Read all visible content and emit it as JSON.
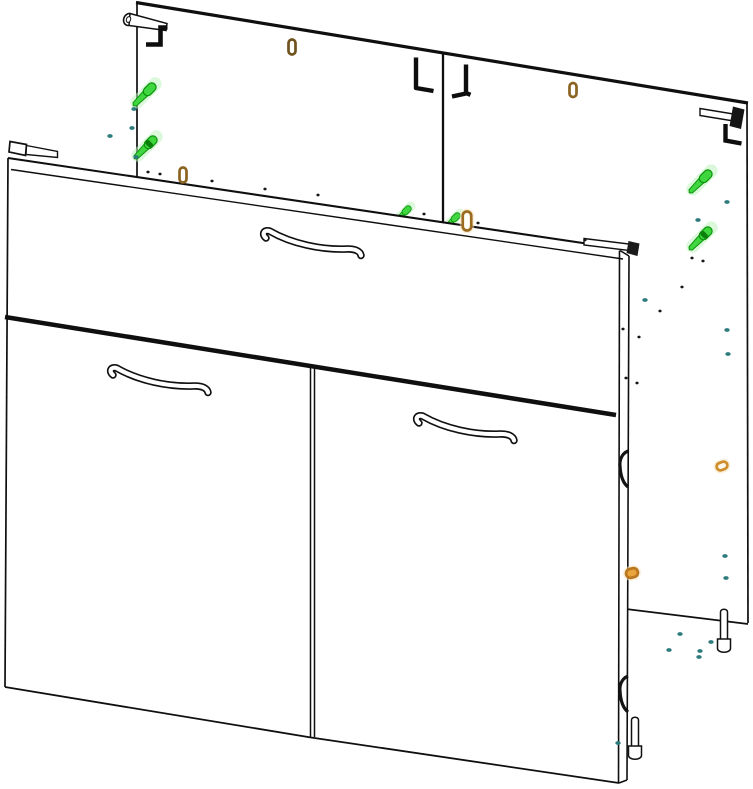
{
  "meta": {
    "title": "cabinet-assembly-diagram",
    "canvas": {
      "w": 753,
      "h": 789
    },
    "bg": "#ffffff"
  },
  "palette": {
    "line": "#0f0f0f",
    "green": "#3fd63f",
    "green_dark": "#0b930b",
    "green_glow": "#bdf3bd",
    "green_band": "#0a7f0a",
    "teal": "#2e7b7e",
    "black_dot": "#161616",
    "white": "#ffffff"
  },
  "shapes": {
    "handle": {
      "d": "M7,9 C3,6 4,0.5 10.5,2 C33,15 63,21 87.5,20 C96.5,19.6 101.5,22.5 102,26.5",
      "outer_w": 7.5,
      "inner_w": 4.2,
      "outer_color": "#101010",
      "inner_color": "#ffffff"
    }
  },
  "scene": {
    "items": [
      {
        "name": "back-panels-surface",
        "type": "polygon",
        "points": "137,3 747,103 748,624 137,550",
        "fill": "#ffffff",
        "stroke": "none",
        "sw": 0
      },
      {
        "name": "back-panel-top-edge",
        "type": "line",
        "x1": 136,
        "y1": 2.5,
        "x2": 748,
        "y2": 103,
        "sw": 3.2
      },
      {
        "name": "back-panel-left-edge",
        "type": "line",
        "x1": 137,
        "y1": 3,
        "x2": 137,
        "y2": 180,
        "sw": 1.7
      },
      {
        "name": "back-panel-center-seam",
        "type": "line",
        "x1": 443,
        "y1": 53,
        "x2": 443,
        "y2": 226,
        "sw": 2.3
      },
      {
        "name": "back-panel-right-edge",
        "type": "line",
        "x1": 747,
        "y1": 102,
        "x2": 748,
        "y2": 623,
        "sw": 1.7
      },
      {
        "name": "back-panel-bottom-edge",
        "type": "line",
        "x1": 626,
        "y1": 609,
        "x2": 748,
        "y2": 624,
        "sw": 1.7
      },
      {
        "name": "hanging-bracket-left",
        "type": "multi",
        "parts": [
          {
            "tag": "ellipse",
            "cx": 128.5,
            "cy": 19.5,
            "rx": 4.8,
            "ry": 6,
            "transform": "rotate(18 128.5 19.5)",
            "fill": "#ffffff",
            "stroke": "#111111",
            "stroke-width": 1.6
          },
          {
            "tag": "path",
            "d": "M130,13.5 L167,23.5 L166,30.5 L129,25.5 Z",
            "fill": "#ffffff",
            "stroke": "#111111",
            "stroke-width": 1.5
          },
          {
            "tag": "ellipse",
            "cx": 128.5,
            "cy": 19.5,
            "rx": 2.1,
            "ry": 3,
            "transform": "rotate(18 128.5 19.5)",
            "fill": "#ffffff",
            "stroke": "#111111",
            "stroke-width": 1
          },
          {
            "tag": "path",
            "d": "M167.5,27.5 L160.5,27.5 L160.5,44.5 L146,44.5",
            "fill": "none",
            "stroke": "#0d0d0d",
            "stroke-width": 4.6
          }
        ]
      },
      {
        "name": "hanging-hook-mid-left",
        "type": "path",
        "d": "M416,57.5 L416,88 L433.5,91",
        "fill": "none",
        "color": "#0d0d0d",
        "sw": 4.4
      },
      {
        "name": "hanging-hook-mid-right",
        "type": "path",
        "d": "M466,64.5 L466,93.5 L452,96.5 M466,93 L470.5,94.8",
        "fill": "none",
        "color": "#0d0d0d",
        "sw": 4.4
      },
      {
        "name": "hanging-bracket-right",
        "type": "multi",
        "parts": [
          {
            "tag": "path",
            "d": "M700,108.5 L733.5,114 L733.5,121 L700,115.5 Z",
            "fill": "#ffffff",
            "stroke": "#111111",
            "stroke-width": 1.4
          },
          {
            "tag": "path",
            "d": "M733,106.5 L744.5,109.5 L741,129 L729.5,126 Z",
            "fill": "#151515",
            "stroke": "none"
          },
          {
            "tag": "path",
            "d": "M725.5,124 L725.5,140.5 L741.5,143.5",
            "fill": "none",
            "stroke": "#0d0d0d",
            "stroke-width": 4.4
          }
        ]
      },
      {
        "name": "confirmat-screw-center-left",
        "type": "screw",
        "x": 404,
        "y": 213,
        "s": 0.72,
        "band": false
      },
      {
        "name": "confirmat-screw-center-right",
        "type": "screw",
        "x": 453,
        "y": 220,
        "s": 0.72,
        "band": false
      },
      {
        "name": "front-assembly-surface",
        "type": "polygon",
        "points": "8,158 630,250 627,780 619,783 311,737 5,687",
        "fill": "#ffffff",
        "stroke": "none",
        "sw": 0
      },
      {
        "name": "drawer-front-top-edge",
        "type": "line",
        "x1": 8,
        "y1": 158,
        "x2": 630,
        "y2": 250,
        "sw": 2.1
      },
      {
        "name": "drawer-front-top-inner-edge",
        "type": "line",
        "x1": 11,
        "y1": 169.5,
        "x2": 623,
        "y2": 259,
        "sw": 1.4
      },
      {
        "name": "front-left-edge",
        "type": "line",
        "x1": 8,
        "y1": 158,
        "x2": 5,
        "y2": 687,
        "sw": 1.7
      },
      {
        "name": "drawer-door-gap-line",
        "type": "line",
        "x1": 5,
        "y1": 317,
        "x2": 616,
        "y2": 415,
        "sw": 4.5
      },
      {
        "name": "door-divider-line-a",
        "type": "line",
        "x1": 310.5,
        "y1": 367,
        "x2": 310.5,
        "y2": 737,
        "sw": 1.5
      },
      {
        "name": "door-divider-line-b",
        "type": "line",
        "x1": 314.5,
        "y1": 368,
        "x2": 314.5,
        "y2": 737,
        "sw": 1.5
      },
      {
        "name": "left-door-bottom-edge",
        "type": "line",
        "x1": 5,
        "y1": 687,
        "x2": 311,
        "y2": 737.5,
        "sw": 1.8
      },
      {
        "name": "right-door-bottom-edge",
        "type": "line",
        "x1": 311,
        "y1": 737.5,
        "x2": 619,
        "y2": 783,
        "sw": 1.8
      },
      {
        "name": "front-right-corner-edge",
        "type": "line",
        "x1": 620,
        "y1": 250.5,
        "x2": 629,
        "y2": 256,
        "sw": 1.5
      },
      {
        "name": "front-right-inner-edge",
        "type": "line",
        "x1": 619.5,
        "y1": 250.5,
        "x2": 618.5,
        "y2": 782.5,
        "sw": 1.6
      },
      {
        "name": "front-right-outer-edge",
        "type": "line",
        "x1": 629,
        "y1": 256,
        "x2": 627,
        "y2": 780,
        "sw": 1.6
      },
      {
        "name": "front-right-bottom-edge",
        "type": "line",
        "x1": 619,
        "y1": 783,
        "x2": 627,
        "y2": 780,
        "sw": 1.6
      },
      {
        "name": "door-hinge-upper",
        "type": "path",
        "d": "M628,451 C621,454 619.5,461 620,466 C620.5,476 623,483 628,487",
        "fill": "none",
        "color": "#141414",
        "sw": 3.2
      },
      {
        "name": "door-hinge-lower",
        "type": "path",
        "d": "M628,676 C621,679 619.5,686 620,691 C620.5,701 623,708 628,712",
        "fill": "none",
        "color": "#141414",
        "sw": 3.2
      },
      {
        "name": "drawer-handle",
        "type": "handle",
        "x": 259,
        "y": 229
      },
      {
        "name": "left-door-handle",
        "type": "handle",
        "x": 106,
        "y": 366
      },
      {
        "name": "right-door-handle",
        "type": "handle",
        "x": 412,
        "y": 414
      },
      {
        "name": "cam-pin-front-left",
        "type": "multi",
        "parts": [
          {
            "tag": "path",
            "d": "M10,141.5 L26.5,144.5 L25.5,155.5 L9,152 Z",
            "fill": "#ffffff",
            "stroke": "#111111",
            "stroke-width": 1.7
          },
          {
            "tag": "path",
            "d": "M26.5,145.5 L57.5,151.5 L57.5,157.5 L26,154.5 Z",
            "fill": "#ffffff",
            "stroke": "#111111",
            "stroke-width": 1.4
          }
        ]
      },
      {
        "name": "cam-pin-front-right",
        "type": "multi",
        "parts": [
          {
            "tag": "path",
            "d": "M584,238.5 L629,244 L629,250.5 L584,245 Z",
            "fill": "#ffffff",
            "stroke": "#111111",
            "stroke-width": 1.4
          },
          {
            "tag": "path",
            "d": "M628.5,241 L639.5,243.5 L637.5,256 L626.5,253 Z",
            "fill": "#1a1a1a",
            "stroke": "none"
          }
        ]
      },
      {
        "name": "confirmat-screw-left-upper",
        "type": "screw",
        "x": 146,
        "y": 93,
        "s": 1,
        "band": false
      },
      {
        "name": "confirmat-screw-left-lower",
        "type": "screw",
        "x": 147,
        "y": 146,
        "s": 1,
        "band": true
      },
      {
        "name": "confirmat-screw-right-upper",
        "type": "screw",
        "x": 702,
        "y": 180,
        "s": 1,
        "band": false
      },
      {
        "name": "confirmat-screw-right-lower",
        "type": "screw",
        "x": 702,
        "y": 237,
        "s": 1,
        "band": true
      },
      {
        "name": "dowel-peg-top-center",
        "type": "peg",
        "x": 292,
        "y": 47,
        "w": 7,
        "h": 15,
        "rot": 0,
        "stroke": "#6f521e",
        "fill": "#ffffff",
        "glow": false
      },
      {
        "name": "dowel-peg-top-right",
        "type": "peg",
        "x": 573,
        "y": 90,
        "w": 7,
        "h": 14,
        "rot": 0,
        "stroke": "#8a6420",
        "fill": "#ffffff",
        "glow": false
      },
      {
        "name": "dowel-peg-left",
        "type": "peg",
        "x": 183,
        "y": 175,
        "w": 7,
        "h": 15,
        "rot": 0,
        "stroke": "#8a6420",
        "fill": "#ffffff",
        "glow": false
      },
      {
        "name": "dowel-peg-center",
        "type": "peg",
        "x": 467,
        "y": 221,
        "w": 8.5,
        "h": 19,
        "rot": 0,
        "stroke": "#9c6b1f",
        "fill": "#fffef8",
        "glow": true
      },
      {
        "name": "dowel-peg-right-mid",
        "type": "peg",
        "x": 722,
        "y": 466,
        "w": 11,
        "h": 7.5,
        "rot": -20,
        "stroke": "#cf8d2b",
        "fill": "#fdf6ea",
        "glow": true
      },
      {
        "name": "dowel-peg-right-lower",
        "type": "peg",
        "x": 632,
        "y": 573,
        "w": 12,
        "h": 9,
        "rot": -15,
        "stroke": "#b9761e",
        "fill": "#e9a43c",
        "glow": true
      },
      {
        "name": "cam-bolt-right",
        "type": "multi",
        "parts": [
          {
            "tag": "path",
            "d": "M720.5,612 A3.5,2.8 0 0 1 727.5,612 L727.5,640 L720.5,640 Z",
            "fill": "#ffffff",
            "stroke": "#111111",
            "stroke-width": 1.5
          },
          {
            "tag": "path",
            "d": "M717.5,639 L730.5,639 L730.5,648.5 A6.5,3.8 0 0 1 717.5,648.5 Z",
            "fill": "#ffffff",
            "stroke": "#111111",
            "stroke-width": 1.5
          }
        ]
      },
      {
        "name": "cam-bolt-bottom",
        "type": "multi",
        "parts": [
          {
            "tag": "path",
            "d": "M631.5,720 A3.5,2.8 0 0 1 638.5,720 L638.5,747 L631.5,747 Z",
            "fill": "#ffffff",
            "stroke": "#111111",
            "stroke-width": 1.5
          },
          {
            "tag": "path",
            "d": "M628.5,746 L641.5,746 L641.5,755.5 A6.5,3.8 0 0 1 628.5,755.5 Z",
            "fill": "#ffffff",
            "stroke": "#111111",
            "stroke-width": 1.5
          }
        ]
      },
      {
        "name": "drill-marks-black",
        "type": "dotset",
        "color": "#161616",
        "rx": 1.6,
        "ry": 1.4,
        "points": [
          [
            148,
            172
          ],
          [
            160,
            174
          ],
          [
            212,
            181
          ],
          [
            265,
            189
          ],
          [
            318,
            195
          ],
          [
            424,
            214
          ],
          [
            478,
            223
          ],
          [
            585,
            240
          ],
          [
            692,
            258
          ],
          [
            703,
            261
          ],
          [
            682,
            287
          ],
          [
            660,
            311
          ],
          [
            639,
            337
          ],
          [
            623,
            329
          ],
          [
            626,
            378
          ],
          [
            637,
            383
          ]
        ]
      },
      {
        "name": "pilot-hole-marks-teal",
        "type": "dotset",
        "color": "#2e7b7e",
        "rx": 2.7,
        "ry": 1.9,
        "points": [
          [
            110,
            136
          ],
          [
            132,
            128
          ],
          [
            134,
            109
          ],
          [
            136,
            157
          ],
          [
            727,
            202
          ],
          [
            698,
            220
          ],
          [
            645,
            300
          ],
          [
            727,
            330
          ],
          [
            728,
            354
          ],
          [
            725,
            556
          ],
          [
            726,
            578
          ],
          [
            680,
            634
          ],
          [
            711,
            642
          ],
          [
            669,
            650
          ],
          [
            700,
            651
          ],
          [
            699,
            657
          ],
          [
            618,
            743
          ]
        ]
      }
    ]
  }
}
